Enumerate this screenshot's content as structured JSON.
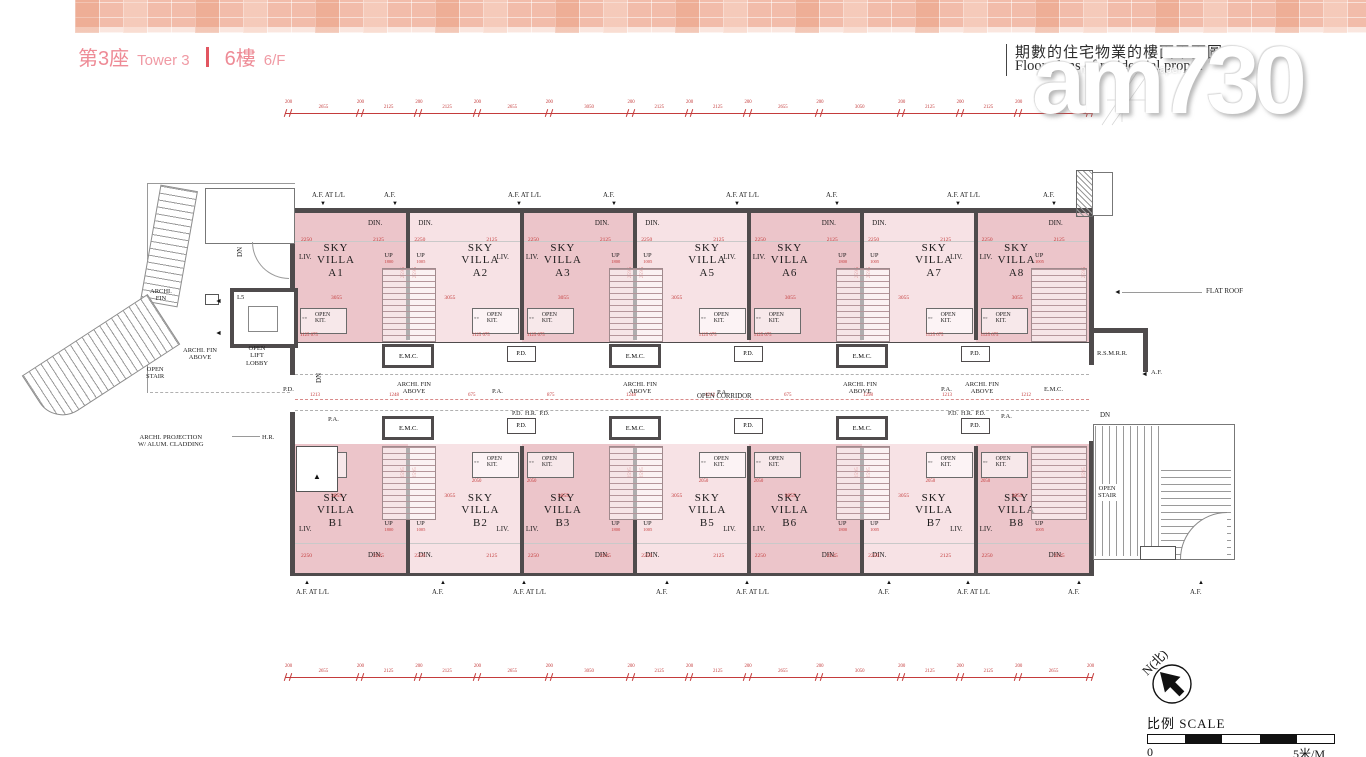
{
  "header": {
    "tower_cn": "第3座",
    "tower_en": "Tower 3",
    "floor_cn": "6樓",
    "floor_en": "6/F",
    "right_title_cn": "期數的住宅物業的樓面平面圖",
    "right_title_en": "Floor plans of residential prope",
    "right_peek": "a"
  },
  "watermark": {
    "logo": "am730",
    "tagline": "my choice, my paper"
  },
  "compass": {
    "label": "N(北)"
  },
  "scale": {
    "label": "比例 SCALE",
    "start": "0",
    "end": "5米/M"
  },
  "plan": {
    "unit_name_lines": "SKY\nVILLA",
    "top_units": [
      "A1",
      "A2",
      "A3",
      "A5",
      "A6",
      "A7",
      "A8"
    ],
    "bottom_units": [
      "B1",
      "B2",
      "B3",
      "B5",
      "B6",
      "B7",
      "B8"
    ],
    "labels": {
      "liv": "LIV.",
      "din": "DIN.",
      "up": "UP",
      "dn": "DN",
      "kit": "OPEN\nKIT.",
      "emc": "E.M.C.",
      "pd": "P.D.",
      "hr": "H.R.",
      "pa": "P.A.",
      "open_corridor": "OPEN CORRIDOR",
      "archi_fin_above": "ARCHI. FIN\nABOVE",
      "pd_hr_pd": "P.D.  H.R.  P.D.",
      "af": "A.F.",
      "af_at_ll": "A.F. AT L/L"
    },
    "left_core": {
      "archi_fin": "ARCHI.\nFIN",
      "archi_fin_above": "ARCHI. FIN\nABOVE",
      "open_lift_lobby": "OPEN\nLIFT\nLOBBY",
      "open_stair": "OPEN\nSTAIR",
      "lift": "L5",
      "dn": "DN",
      "projection": "ARCHI. PROJECTION\nW/ ALUM. CLADDING",
      "hr": "H.R.",
      "pd": "P.D."
    },
    "right_side": {
      "flat_roof": "FLAT ROOF",
      "rsmrr": "R.S.M.R.R.",
      "af": "A.F.",
      "dn": "DN",
      "open_stair": "OPEN\nSTAIR",
      "emc": "E.M.C."
    },
    "dim_chain": [
      "200",
      "2655",
      "200",
      "2125",
      "200",
      "2125",
      "200",
      "2655",
      "200",
      "3050",
      "200",
      "2125",
      "200",
      "2125",
      "200",
      "2655",
      "200",
      "3050",
      "200",
      "2125",
      "200",
      "2125",
      "200",
      "2655",
      "200"
    ],
    "corridor_dims": [
      "1213",
      "1248",
      "675",
      "875",
      "1248",
      "1212",
      "675",
      "1298",
      "1213",
      "1212"
    ],
    "unit_dims": {
      "w1": "2250",
      "w2": "2125",
      "mid": "3055",
      "side": "2595",
      "kit": "1125  675",
      "kit2": "2050"
    },
    "stair_dims": [
      "1800",
      "1005"
    ],
    "top_callouts": [
      {
        "text": "A.F. AT L/L",
        "x": 312
      },
      {
        "text": "A.F.",
        "x": 384
      },
      {
        "text": "A.F. AT L/L",
        "x": 508
      },
      {
        "text": "A.F.",
        "x": 603
      },
      {
        "text": "A.F. AT L/L",
        "x": 726
      },
      {
        "text": "A.F.",
        "x": 826
      },
      {
        "text": "A.F. AT L/L",
        "x": 947
      },
      {
        "text": "A.F.",
        "x": 1043
      }
    ],
    "bottom_callouts": [
      {
        "text": "A.F. AT L/L",
        "x": 296
      },
      {
        "text": "A.F.",
        "x": 432
      },
      {
        "text": "A.F. AT L/L",
        "x": 513
      },
      {
        "text": "A.F.",
        "x": 656
      },
      {
        "text": "A.F. AT L/L",
        "x": 736
      },
      {
        "text": "A.F.",
        "x": 878
      },
      {
        "text": "A.F. AT L/L",
        "x": 957
      },
      {
        "text": "A.F.",
        "x": 1068
      },
      {
        "text": "A.F.",
        "x": 1190
      }
    ],
    "corridor_labels": {
      "pa": [
        [
          328,
          416
        ],
        [
          492,
          388
        ],
        [
          717,
          389
        ],
        [
          941,
          386
        ],
        [
          1001,
          413
        ]
      ],
      "archi_fin_above": [
        [
          397,
          381
        ],
        [
          623,
          381
        ],
        [
          843,
          381
        ],
        [
          965,
          381
        ]
      ],
      "open_corridor": [
        697,
        393
      ],
      "pd_hr_pd": [
        [
          512,
          411
        ],
        [
          948,
          411
        ]
      ]
    },
    "colors": {
      "unit_dark": "#ecc5ca",
      "unit_light": "#f7e2e5",
      "wall": "#4f4b4c",
      "dim_red": "#c43b3b",
      "accent_pink": "#ee8b96"
    }
  }
}
